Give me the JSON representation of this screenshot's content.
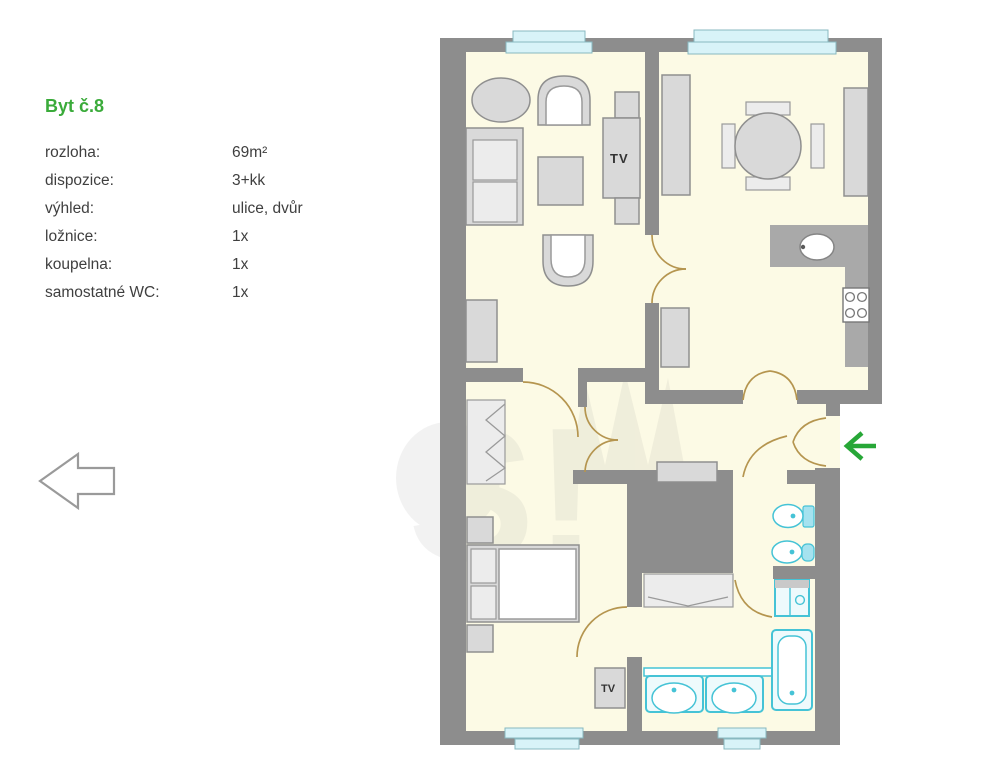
{
  "legend": {
    "title": "Byt č.8",
    "title_color": "#3aab3a",
    "rows": [
      {
        "label": "rozloha:",
        "value": "69m²"
      },
      {
        "label": "dispozice:",
        "value": "3+kk"
      },
      {
        "label": "výhled:",
        "value": "ulice, dvůr"
      },
      {
        "label": "ložnice:",
        "value": "1x"
      },
      {
        "label": "koupelna:",
        "value": "1x"
      },
      {
        "label": "samostatné WC:",
        "value": "1x"
      }
    ]
  },
  "plan": {
    "tv_label_living": "TV",
    "tv_label_bedroom": "TV",
    "colors": {
      "wall": "#8d8d8d",
      "floor": "#fcfae5",
      "furniture": "#d9d9d9",
      "fixture_cyan": "#45c3d6",
      "window": "#d8f3f8",
      "door_arc": "#b5954f",
      "entrance_arrow_green": "#27a737"
    }
  }
}
